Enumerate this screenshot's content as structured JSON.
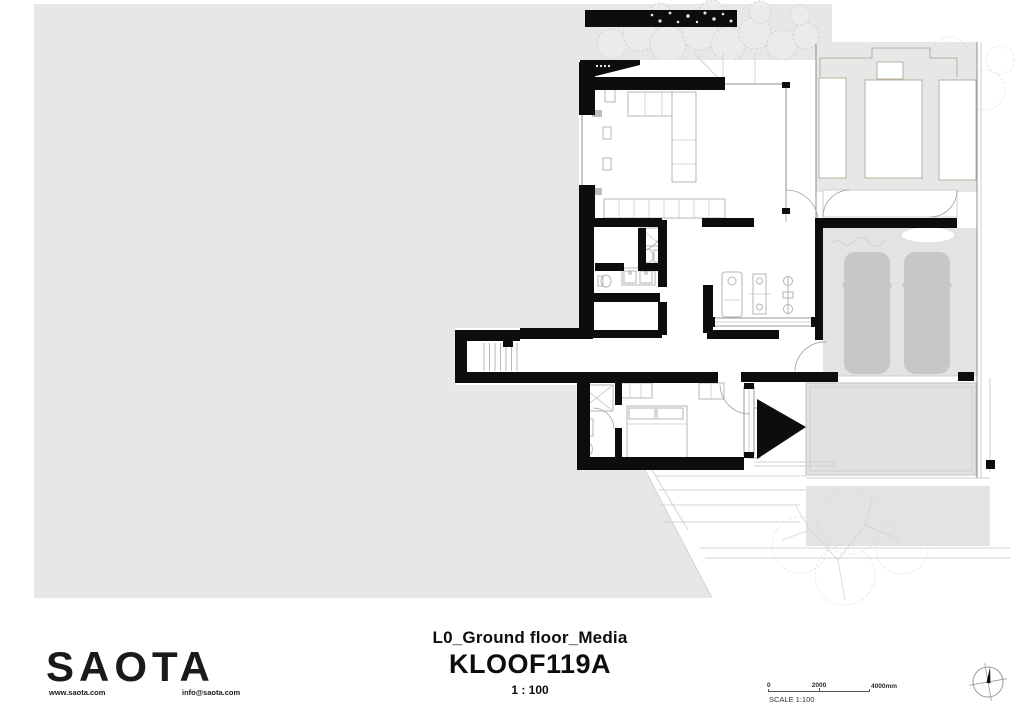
{
  "colors": {
    "page_bg": "#ffffff",
    "site_gray": "#e7e7e7",
    "driveway_gray": "#e3e3e3",
    "car_gray": "#c7c7c7",
    "pool_gray": "#e1e1e1",
    "lower_terrace_gray": "#e3e3e3",
    "wall_black": "#0d0d0d",
    "glass_line": "#8c8c8c",
    "furniture_line": "#b5b5b5",
    "neighbor_outline": "#b9b19f",
    "vegetation_line": "#d2d2d2"
  },
  "title_block": {
    "drawing_title": "L0_Ground floor_Media",
    "project_code": "KLOOF119A",
    "scale_text": "1 : 100"
  },
  "branding": {
    "logo_text": "SAOTA",
    "website": "www.saota.com",
    "email": "info@saota.com"
  },
  "scale_bar": {
    "tick_start": "0",
    "tick_mid": "2000",
    "tick_end": "4000mm",
    "caption": "SCALE 1:100"
  }
}
